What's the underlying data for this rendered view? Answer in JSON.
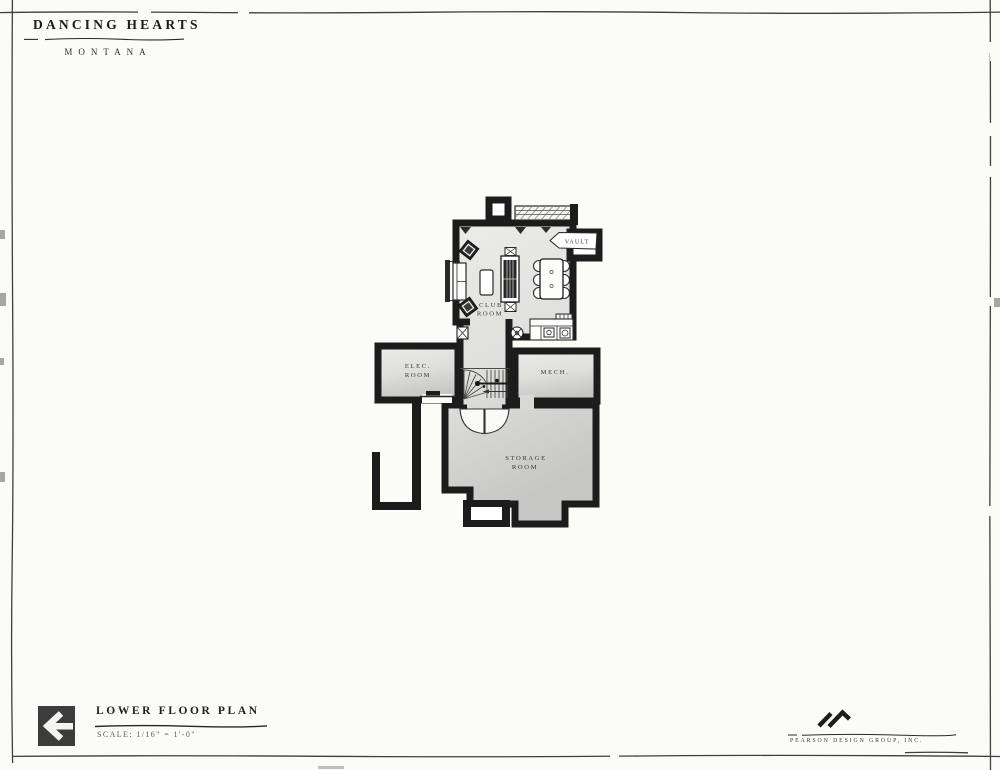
{
  "page": {
    "paper_color": "#fbfbf8",
    "frame_color": "#3f3f3d"
  },
  "header": {
    "project_title": "DANCING HEARTS",
    "project_location": "MONTANA"
  },
  "title_block": {
    "drawing_title": "LOWER FLOOR PLAN",
    "scale_label": "SCALE: 1/16\" = 1'-0\"",
    "icon": "left-arrow-icon",
    "icon_background": "#3c3c3c"
  },
  "firm": {
    "name": "PEARSON DESIGN GROUP, INC.",
    "logo": "mountain-peaks-logo"
  },
  "floor_plan": {
    "colors": {
      "wall": "#1c1c1c",
      "floor_light": "#eaeae8",
      "floor_dark": "#c6c6c4",
      "paper": "#fbfbf8"
    },
    "rooms": {
      "club_room": {
        "line1": "CLUB",
        "line2": "ROOM"
      },
      "vault": {
        "label": "VAULT"
      },
      "elec_room": {
        "line1": "ELEC.",
        "line2": "ROOM"
      },
      "mech_room": {
        "label": "MECH."
      },
      "storage_room": {
        "line1": "STORAGE",
        "line2": "ROOM"
      }
    },
    "features": [
      "window-wells",
      "sofa",
      "armchairs",
      "coffee-table",
      "media-cabinet",
      "dining-table-six-chairs",
      "bar-counter-with-sink",
      "curved-stair",
      "double-entry-doors",
      "retaining-wall"
    ]
  }
}
